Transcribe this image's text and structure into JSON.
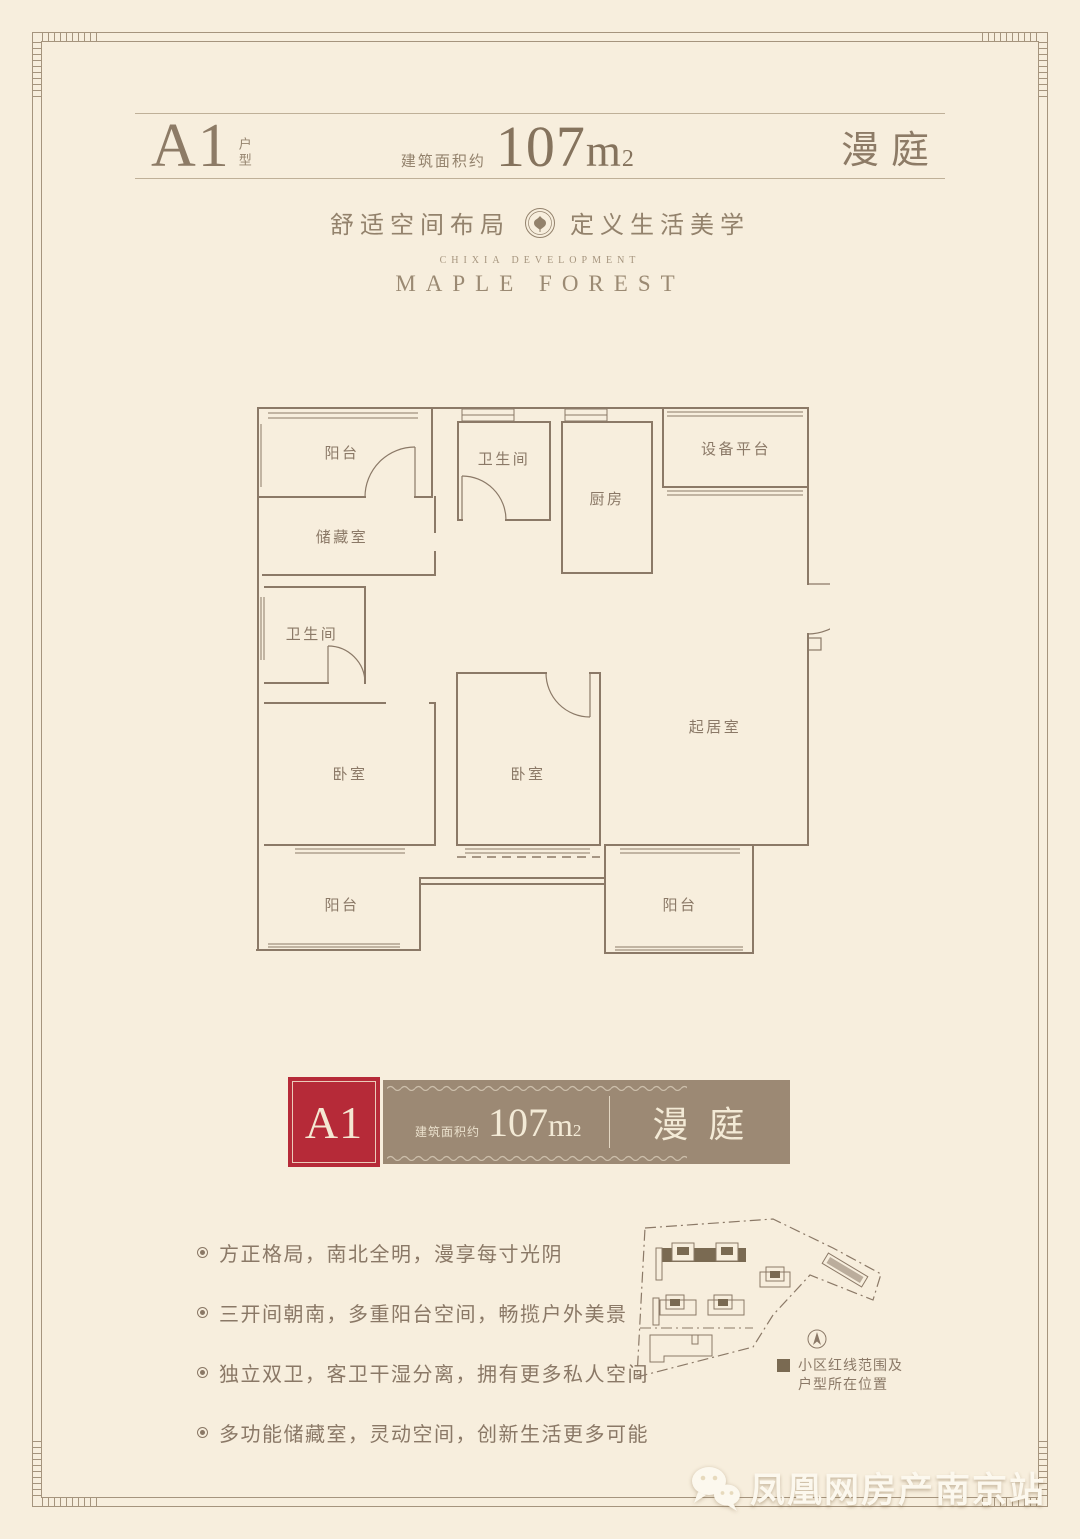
{
  "colors": {
    "background": "#f7eedd",
    "frame": "#a5947d",
    "ink": "#8b7967",
    "accent_red": "#b62a38",
    "banner_brown": "#9c8974",
    "cream_text": "#f3ead6",
    "highlight_dark": "#7a6a52"
  },
  "header": {
    "unit": "A1",
    "unit_suffix": "户型",
    "area_label": "建筑面积约",
    "area_value": "107",
    "area_unit": "m",
    "area_exp": "2",
    "project_name": "漫庭"
  },
  "tagline": {
    "left": "舒适空间布局",
    "right": "定义生活美学"
  },
  "brand": {
    "line1": "CHIXIA DEVELOPMENT",
    "line2": "MAPLE FOREST"
  },
  "floorplan": {
    "rooms": {
      "balcony_top": "阳台",
      "bath_top": "卫生间",
      "kitchen": "厨房",
      "equipment": "设备平台",
      "storage": "储藏室",
      "bath_left": "卫生间",
      "bedroom_left": "卧室",
      "bedroom_mid": "卧室",
      "living": "起居室",
      "balcony_bl": "阳台",
      "balcony_br": "阳台"
    }
  },
  "banner": {
    "unit": "A1",
    "area_label": "建筑面积约",
    "area_value": "107",
    "area_unit": "m",
    "area_exp": "2",
    "project_name": "漫庭"
  },
  "features": [
    "方正格局，南北全明，漫享每寸光阴",
    "三开间朝南，多重阳台空间，畅揽户外美景",
    "独立双卫，客卫干湿分离，拥有更多私人空间",
    "多功能储藏室，灵动空间，创新生活更多可能"
  ],
  "siteplan": {
    "legend_line1": "小区红线范围及",
    "legend_line2": "户型所在位置"
  },
  "watermark": {
    "text": "凤凰网房产南京站"
  }
}
